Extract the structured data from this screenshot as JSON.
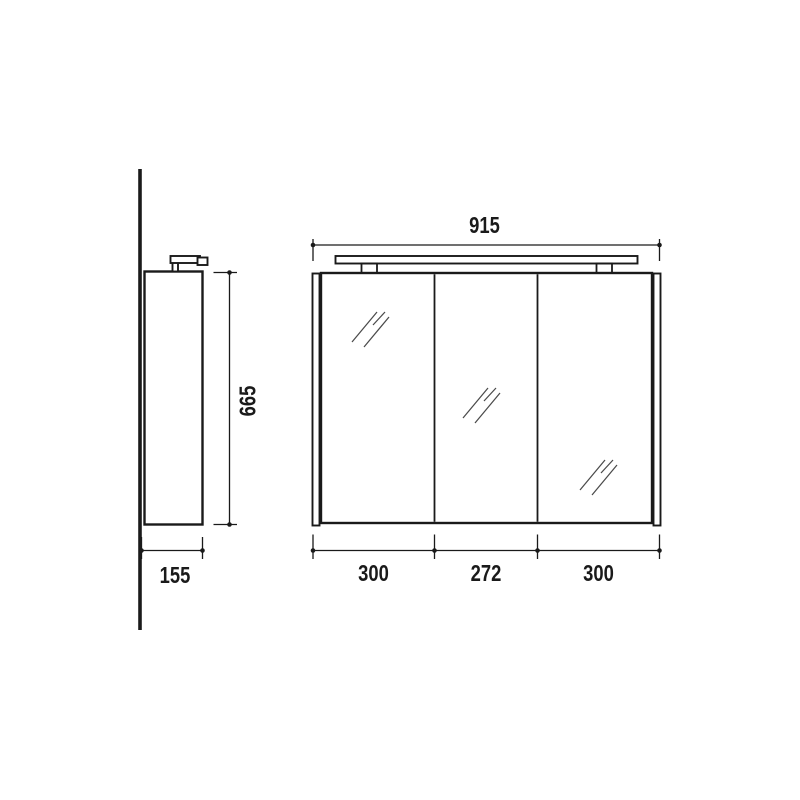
{
  "colors": {
    "line": "#1a1a1a",
    "hatch": "#4a4a4a",
    "background": "#ffffff"
  },
  "drawing": {
    "side_view": {
      "height_label": "665",
      "depth_label": "155"
    },
    "front_view": {
      "width_label": "915",
      "door_labels": [
        "300",
        "272",
        "300"
      ]
    }
  }
}
